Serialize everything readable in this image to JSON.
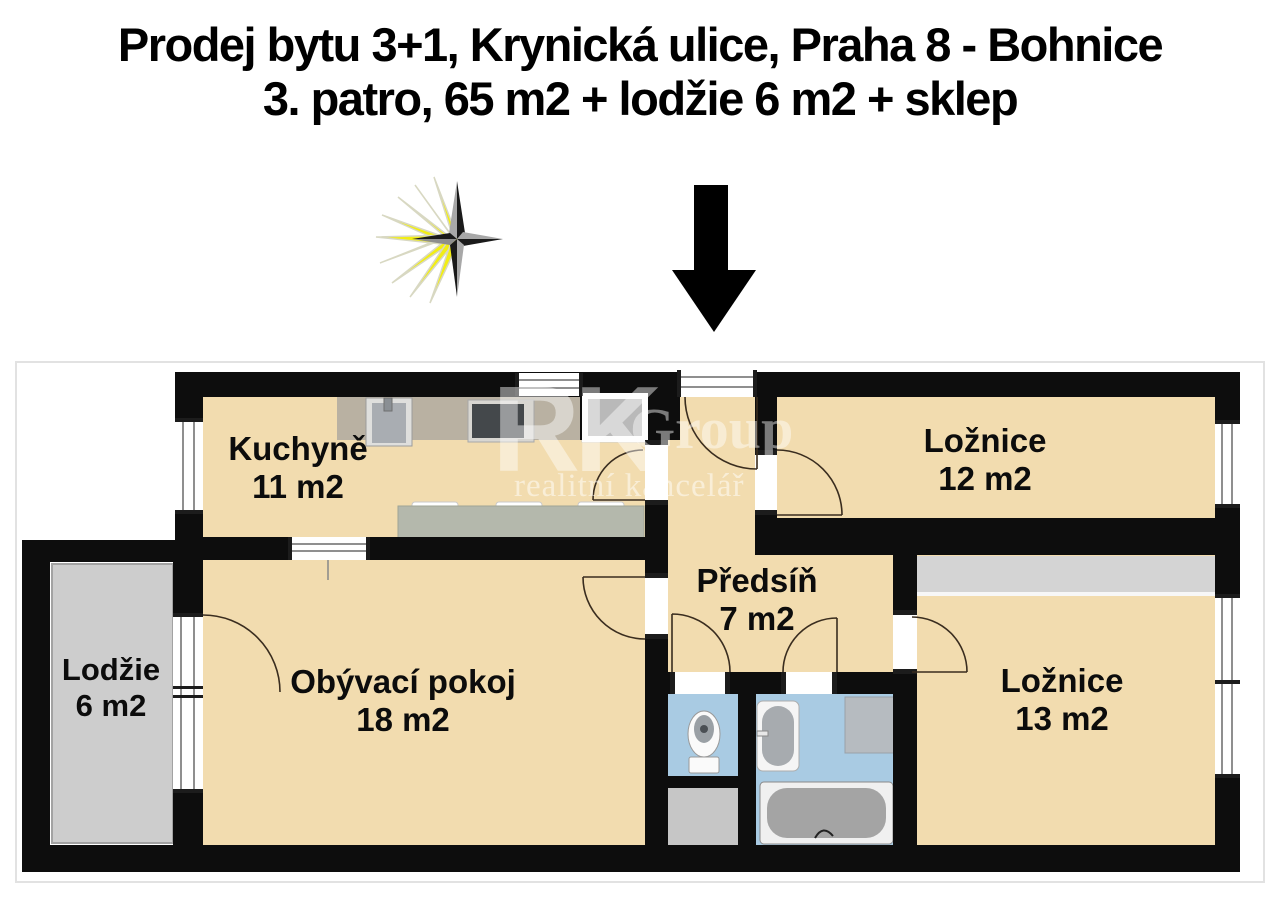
{
  "title": {
    "line1": "Prodej bytu 3+1, Krynická ulice, Praha 8 - Bohnice",
    "line2": "3. patro, 65 m2 + lodžie 6 m2 + sklep"
  },
  "watermark": {
    "rk": "RK",
    "group": "Group",
    "subtitle": "realitní kancelář"
  },
  "rooms": [
    {
      "id": "kuchyne",
      "name": "Kuchyně",
      "area": "11 m2"
    },
    {
      "id": "loznice12",
      "name": "Ložnice",
      "area": "12 m2"
    },
    {
      "id": "lodzie",
      "name": "Lodžie",
      "area": "6 m2"
    },
    {
      "id": "obyvaci",
      "name": "Obývací pokoj",
      "area": "18 m2"
    },
    {
      "id": "predsin",
      "name": "Předsíň",
      "area": "7 m2"
    },
    {
      "id": "loznice13",
      "name": "Ložnice",
      "area": "13 m2"
    }
  ],
  "icons": {
    "compass": "compass-rose-icon",
    "entrance_arrow": "down-arrow-icon"
  },
  "fixtures": [
    "kitchen-counter",
    "sink",
    "stove",
    "entry-cabinet",
    "dining-table",
    "toilet",
    "bathroom-sink",
    "washing-machine",
    "bathtub",
    "wardrobe",
    "utility-shaft"
  ],
  "colors": {
    "floor": "#f2dcaf",
    "tile": "#a9cbe3",
    "loggia": "#cdcdcd",
    "counter": "#b9b1a2",
    "table": "#b4b8ac",
    "wardrobe": "#d4d4d4",
    "wall": "#0d0d0d",
    "ray": "#f2ee13",
    "star_dark": "#1a1a1a",
    "star_gray": "#a8a8a8"
  }
}
